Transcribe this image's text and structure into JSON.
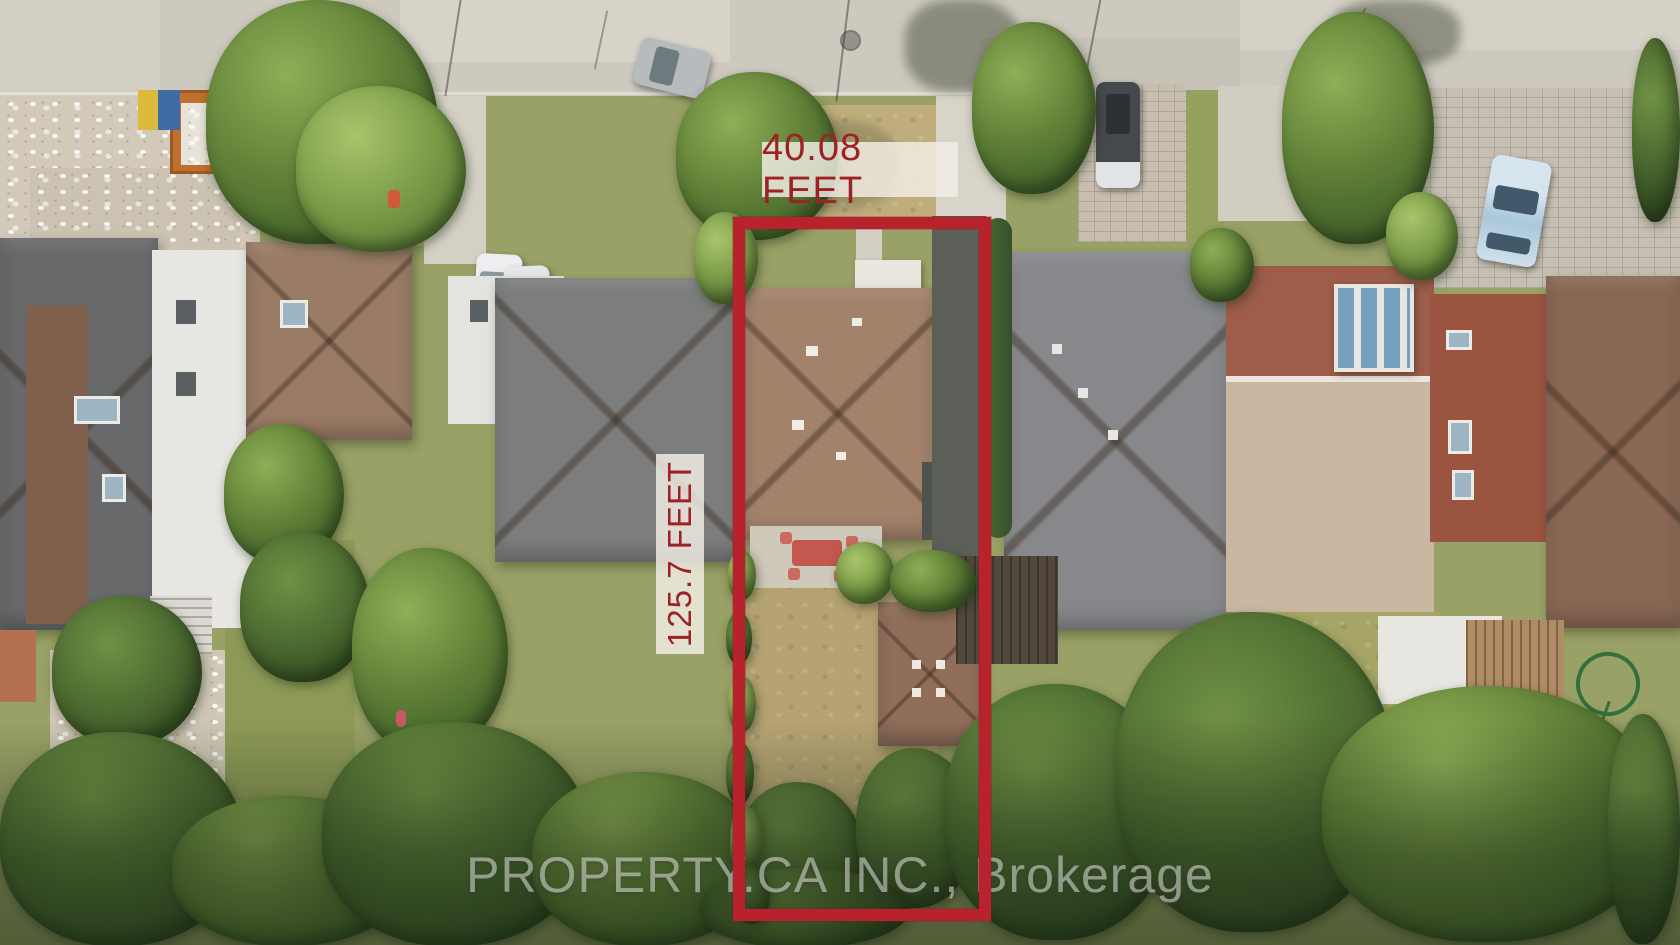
{
  "image_type": "aerial drone real-estate photograph",
  "annotations": {
    "lot_outline": {
      "shape": "rectangle",
      "color": "#b8222d",
      "left_px": 733,
      "top_px": 217,
      "width_px": 258,
      "height_px": 704,
      "stroke_px": 12
    },
    "frontage_label": {
      "text": "40.08 FEET",
      "color": "#9e2125",
      "background": "rgba(243,239,230,0.82)",
      "position": "above top edge of lot outline"
    },
    "depth_label": {
      "text": "125.7 FEET",
      "color": "#9e2125",
      "background": "rgba(243,239,230,0.82)",
      "orientation": "vertical, reads bottom-to-top",
      "position": "left of lot outline"
    }
  },
  "watermark": {
    "text": "PROPERTY.CA INC., Brokerage",
    "color": "rgba(233,236,230,0.52)",
    "position": "bottom center"
  },
  "scene": {
    "description": "Top-down aerial view of a residential street: concrete road across the top, a row of houses (dark-gray modern, brown hip roof, gray hip roof, the outlined subject house with brown hip roof and rear garage, a large gray hip-roof neighbour, a flat-roof brick house with white glass atrium, and a brown-roof house at far right), parked cars, an orange construction dumpster with debris at left, long tree-filled backyards at the bottom",
    "key_colors": {
      "road": "#cdc9bf",
      "dry_grass": "#bfad7c",
      "green_grass": "#95a15e",
      "tree_canopy": "#46652c",
      "subject_roof": "#a2826b",
      "neighbor_gray_roof": "#86888b",
      "driveway_asphalt": "#5c5f58",
      "dumpster_orange": "#c06f2e"
    }
  }
}
